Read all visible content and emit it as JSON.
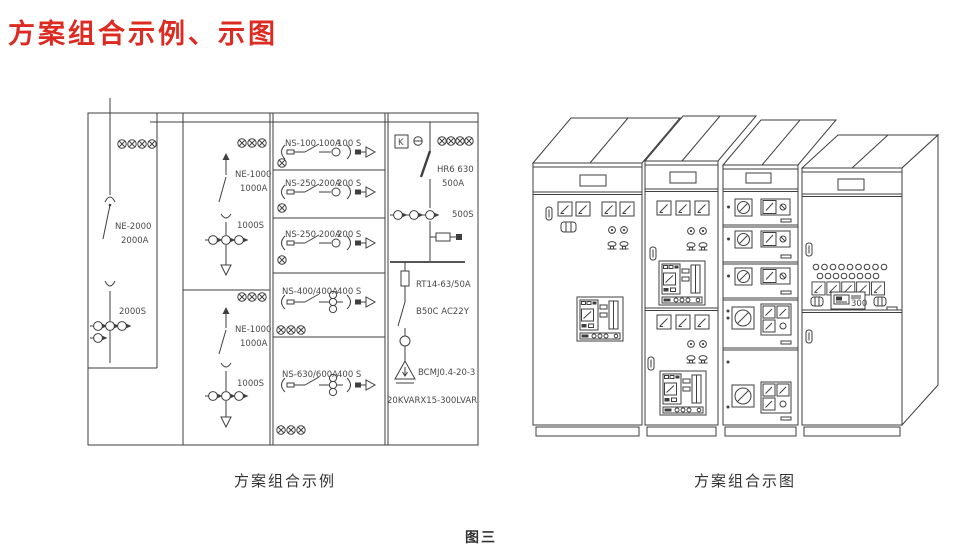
{
  "page": {
    "title": "方案组合示例、示图",
    "figure_label": "图三",
    "accent_color": "#dd2b22",
    "line_color": "#3f3f3f"
  },
  "left_diagram": {
    "caption": "方案组合示例",
    "incoming": {
      "model": "NE-2000",
      "amp": "2000A",
      "ct": "2000S"
    },
    "sections": [
      {
        "model": "NE-1000",
        "amp": "1000A",
        "ct": "1000S"
      },
      {
        "model": "NE-1000",
        "amp": "1000A",
        "ct": "1000S"
      }
    ],
    "feeders": [
      {
        "label": "NS-100 100A",
        "ct": "100 S"
      },
      {
        "label": "NS-250 200A",
        "ct": "200 S"
      },
      {
        "label": "NS-250 200A",
        "ct": "200 S"
      },
      {
        "label": "NS-400/400A",
        "ct": "400 S"
      },
      {
        "label": "NS-630/600A",
        "ct": "400 S"
      }
    ],
    "capacitor_branch": {
      "meter_k": "K",
      "switch_model": "HR6 630",
      "switch_amp": "500A",
      "ct": "500S",
      "fuse": "RT14-63/50A",
      "contactor": "B50C  AC22Y",
      "capacitor_model": "BCMJ0.4-20-3",
      "capacitor_rating": "20KVARX15-300LVAR"
    }
  },
  "right_drawing": {
    "caption": "方案组合示图",
    "meter_display": "300"
  }
}
